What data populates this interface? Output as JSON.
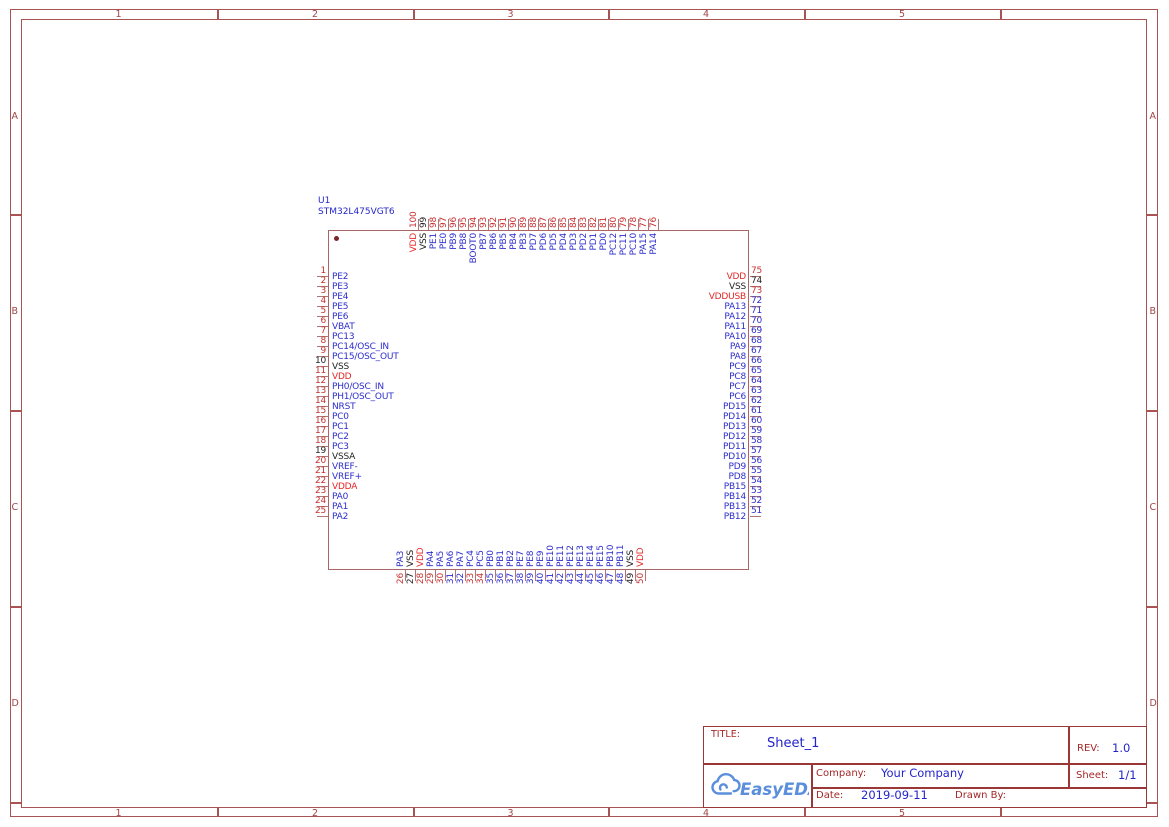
{
  "colors": {
    "canvas_background": "#ffffff",
    "frame_border": "#a85454",
    "marker_text": "#a04545",
    "chip_outline": "#aa6666",
    "pin_line": "#b07474",
    "title_block_line": "#9a3838",
    "title_block_label": "#a52828",
    "value_blue": "#2424cc",
    "logo_blue": "#5b8fdb",
    "pin_palette": {
      "r": "#c63030",
      "b": "#2d2dcc",
      "k": "#222222",
      "R": "#e62626"
    }
  },
  "frame": {
    "columns": [
      "1",
      "2",
      "3",
      "4",
      "5"
    ],
    "rows": [
      "A",
      "B",
      "C",
      "D"
    ]
  },
  "component": {
    "ref": "U1",
    "value": "STM32L475VGT6",
    "pins": {
      "left": [
        {
          "num": "1",
          "name": "PE2",
          "nc": "r",
          "lc": "b"
        },
        {
          "num": "2",
          "name": "PE3",
          "nc": "r",
          "lc": "b"
        },
        {
          "num": "3",
          "name": "PE4",
          "nc": "r",
          "lc": "b"
        },
        {
          "num": "4",
          "name": "PE5",
          "nc": "r",
          "lc": "b"
        },
        {
          "num": "5",
          "name": "PE6",
          "nc": "r",
          "lc": "b"
        },
        {
          "num": "6",
          "name": "VBAT",
          "nc": "r",
          "lc": "b"
        },
        {
          "num": "7",
          "name": "PC13",
          "nc": "r",
          "lc": "b"
        },
        {
          "num": "8",
          "name": "PC14/OSC_IN",
          "nc": "r",
          "lc": "b"
        },
        {
          "num": "9",
          "name": "PC15/OSC_OUT",
          "nc": "r",
          "lc": "b"
        },
        {
          "num": "10",
          "name": "VSS",
          "nc": "k",
          "lc": "k"
        },
        {
          "num": "11",
          "name": "VDD",
          "nc": "r",
          "lc": "R"
        },
        {
          "num": "12",
          "name": "PH0/OSC_IN",
          "nc": "r",
          "lc": "b"
        },
        {
          "num": "13",
          "name": "PH1/OSC_OUT",
          "nc": "r",
          "lc": "b"
        },
        {
          "num": "14",
          "name": "NRST",
          "nc": "r",
          "lc": "b"
        },
        {
          "num": "15",
          "name": "PC0",
          "nc": "r",
          "lc": "b"
        },
        {
          "num": "16",
          "name": "PC1",
          "nc": "r",
          "lc": "b"
        },
        {
          "num": "17",
          "name": "PC2",
          "nc": "r",
          "lc": "b"
        },
        {
          "num": "18",
          "name": "PC3",
          "nc": "r",
          "lc": "b"
        },
        {
          "num": "19",
          "name": "VSSA",
          "nc": "k",
          "lc": "k"
        },
        {
          "num": "20",
          "name": "VREF-",
          "nc": "r",
          "lc": "b"
        },
        {
          "num": "21",
          "name": "VREF+",
          "nc": "r",
          "lc": "b"
        },
        {
          "num": "22",
          "name": "VDDA",
          "nc": "r",
          "lc": "R"
        },
        {
          "num": "23",
          "name": "PA0",
          "nc": "r",
          "lc": "b"
        },
        {
          "num": "24",
          "name": "PA1",
          "nc": "r",
          "lc": "b"
        },
        {
          "num": "25",
          "name": "PA2",
          "nc": "r",
          "lc": "b"
        }
      ],
      "top": [
        {
          "num": "100",
          "name": "VDD",
          "nc": "r",
          "lc": "R"
        },
        {
          "num": "99",
          "name": "VSS",
          "nc": "k",
          "lc": "k"
        },
        {
          "num": "98",
          "name": "PE1",
          "nc": "r",
          "lc": "b"
        },
        {
          "num": "97",
          "name": "PE0",
          "nc": "r",
          "lc": "b"
        },
        {
          "num": "96",
          "name": "PB9",
          "nc": "r",
          "lc": "b"
        },
        {
          "num": "95",
          "name": "PB8",
          "nc": "r",
          "lc": "b"
        },
        {
          "num": "94",
          "name": "BOOT0",
          "nc": "r",
          "lc": "b"
        },
        {
          "num": "93",
          "name": "PB7",
          "nc": "r",
          "lc": "b"
        },
        {
          "num": "92",
          "name": "PB6",
          "nc": "r",
          "lc": "b"
        },
        {
          "num": "91",
          "name": "PB5",
          "nc": "r",
          "lc": "b"
        },
        {
          "num": "90",
          "name": "PB4",
          "nc": "r",
          "lc": "b"
        },
        {
          "num": "89",
          "name": "PB3",
          "nc": "r",
          "lc": "b"
        },
        {
          "num": "88",
          "name": "PD7",
          "nc": "r",
          "lc": "b"
        },
        {
          "num": "87",
          "name": "PD6",
          "nc": "r",
          "lc": "b"
        },
        {
          "num": "86",
          "name": "PD5",
          "nc": "r",
          "lc": "b"
        },
        {
          "num": "85",
          "name": "PD4",
          "nc": "r",
          "lc": "b"
        },
        {
          "num": "84",
          "name": "PD3",
          "nc": "r",
          "lc": "b"
        },
        {
          "num": "83",
          "name": "PD2",
          "nc": "r",
          "lc": "b"
        },
        {
          "num": "82",
          "name": "PD1",
          "nc": "r",
          "lc": "b"
        },
        {
          "num": "81",
          "name": "PD0",
          "nc": "r",
          "lc": "b"
        },
        {
          "num": "80",
          "name": "PC12",
          "nc": "r",
          "lc": "b"
        },
        {
          "num": "79",
          "name": "PC11",
          "nc": "r",
          "lc": "b"
        },
        {
          "num": "78",
          "name": "PC10",
          "nc": "r",
          "lc": "b"
        },
        {
          "num": "77",
          "name": "PA15",
          "nc": "r",
          "lc": "b"
        },
        {
          "num": "76",
          "name": "PA14",
          "nc": "r",
          "lc": "b"
        }
      ],
      "right": [
        {
          "num": "75",
          "name": "VDD",
          "nc": "r",
          "lc": "R"
        },
        {
          "num": "74",
          "name": "VSS",
          "nc": "k",
          "lc": "k"
        },
        {
          "num": "73",
          "name": "VDDUSB",
          "nc": "r",
          "lc": "R"
        },
        {
          "num": "72",
          "name": "PA13",
          "nc": "b",
          "lc": "b"
        },
        {
          "num": "71",
          "name": "PA12",
          "nc": "b",
          "lc": "b"
        },
        {
          "num": "70",
          "name": "PA11",
          "nc": "b",
          "lc": "b"
        },
        {
          "num": "69",
          "name": "PA10",
          "nc": "b",
          "lc": "b"
        },
        {
          "num": "68",
          "name": "PA9",
          "nc": "b",
          "lc": "b"
        },
        {
          "num": "67",
          "name": "PA8",
          "nc": "b",
          "lc": "b"
        },
        {
          "num": "66",
          "name": "PC9",
          "nc": "b",
          "lc": "b"
        },
        {
          "num": "65",
          "name": "PC8",
          "nc": "b",
          "lc": "b"
        },
        {
          "num": "64",
          "name": "PC7",
          "nc": "b",
          "lc": "b"
        },
        {
          "num": "63",
          "name": "PC6",
          "nc": "b",
          "lc": "b"
        },
        {
          "num": "62",
          "name": "PD15",
          "nc": "b",
          "lc": "b"
        },
        {
          "num": "61",
          "name": "PD14",
          "nc": "b",
          "lc": "b"
        },
        {
          "num": "60",
          "name": "PD13",
          "nc": "b",
          "lc": "b"
        },
        {
          "num": "59",
          "name": "PD12",
          "nc": "b",
          "lc": "b"
        },
        {
          "num": "58",
          "name": "PD11",
          "nc": "b",
          "lc": "b"
        },
        {
          "num": "57",
          "name": "PD10",
          "nc": "b",
          "lc": "b"
        },
        {
          "num": "56",
          "name": "PD9",
          "nc": "b",
          "lc": "b"
        },
        {
          "num": "55",
          "name": "PD8",
          "nc": "b",
          "lc": "b"
        },
        {
          "num": "54",
          "name": "PB15",
          "nc": "b",
          "lc": "b"
        },
        {
          "num": "53",
          "name": "PB14",
          "nc": "b",
          "lc": "b"
        },
        {
          "num": "52",
          "name": "PB13",
          "nc": "b",
          "lc": "b"
        },
        {
          "num": "51",
          "name": "PB12",
          "nc": "b",
          "lc": "b"
        }
      ],
      "bottom": [
        {
          "num": "26",
          "name": "PA3",
          "nc": "r",
          "lc": "b"
        },
        {
          "num": "27",
          "name": "VSS",
          "nc": "k",
          "lc": "k"
        },
        {
          "num": "28",
          "name": "VDD",
          "nc": "r",
          "lc": "R"
        },
        {
          "num": "29",
          "name": "PA4",
          "nc": "r",
          "lc": "b"
        },
        {
          "num": "30",
          "name": "PA5",
          "nc": "r",
          "lc": "b"
        },
        {
          "num": "31",
          "name": "PA6",
          "nc": "b",
          "lc": "b"
        },
        {
          "num": "32",
          "name": "PA7",
          "nc": "b",
          "lc": "b"
        },
        {
          "num": "33",
          "name": "PC4",
          "nc": "r",
          "lc": "b"
        },
        {
          "num": "34",
          "name": "PC5",
          "nc": "r",
          "lc": "b"
        },
        {
          "num": "35",
          "name": "PB0",
          "nc": "b",
          "lc": "b"
        },
        {
          "num": "36",
          "name": "PB1",
          "nc": "b",
          "lc": "b"
        },
        {
          "num": "37",
          "name": "PB2",
          "nc": "b",
          "lc": "b"
        },
        {
          "num": "38",
          "name": "PE7",
          "nc": "b",
          "lc": "b"
        },
        {
          "num": "39",
          "name": "PE8",
          "nc": "b",
          "lc": "b"
        },
        {
          "num": "40",
          "name": "PE9",
          "nc": "b",
          "lc": "b"
        },
        {
          "num": "41",
          "name": "PE10",
          "nc": "b",
          "lc": "b"
        },
        {
          "num": "42",
          "name": "PE11",
          "nc": "b",
          "lc": "b"
        },
        {
          "num": "43",
          "name": "PE12",
          "nc": "b",
          "lc": "b"
        },
        {
          "num": "44",
          "name": "PE13",
          "nc": "b",
          "lc": "b"
        },
        {
          "num": "45",
          "name": "PE14",
          "nc": "b",
          "lc": "b"
        },
        {
          "num": "46",
          "name": "PE15",
          "nc": "b",
          "lc": "b"
        },
        {
          "num": "47",
          "name": "PB10",
          "nc": "b",
          "lc": "b"
        },
        {
          "num": "48",
          "name": "PB11",
          "nc": "b",
          "lc": "b"
        },
        {
          "num": "49",
          "name": "VSS",
          "nc": "k",
          "lc": "k"
        },
        {
          "num": "50",
          "name": "VDD",
          "nc": "r",
          "lc": "R"
        }
      ]
    }
  },
  "title_block": {
    "title_label": "TITLE:",
    "title": "Sheet_1",
    "rev_label": "REV:",
    "rev": "1.0",
    "company_label": "Company:",
    "company": "Your Company",
    "sheet_label": "Sheet:",
    "sheet": "1/1",
    "date_label": "Date:",
    "date": "2019-09-11",
    "drawn_by_label": "Drawn By:",
    "logo_text": "EasyEDA"
  }
}
